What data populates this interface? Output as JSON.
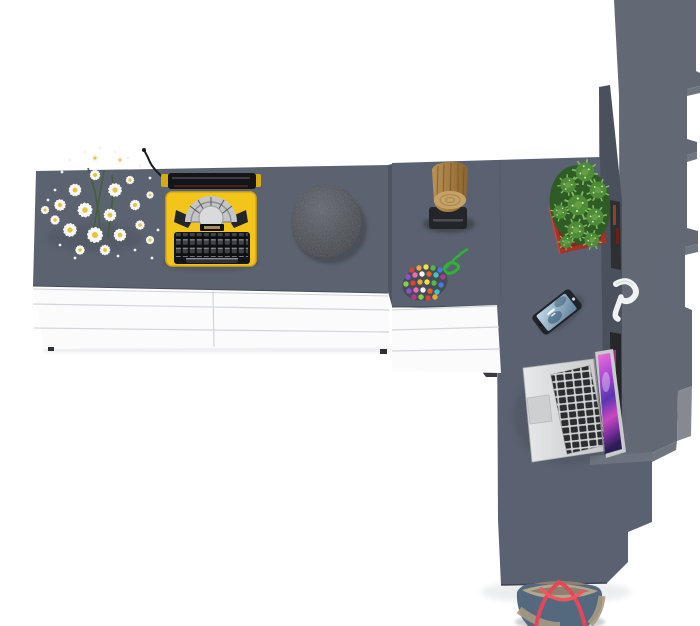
{
  "scene": {
    "title": "Top-down 3D render of an L-shaped desk with sideboard, tall shelf, and desk accessories",
    "background": "#ffffff"
  },
  "items": [
    {
      "name": "daisy-bouquet",
      "label": "white daisy bouquet"
    },
    {
      "name": "typewriter",
      "label": "yellow vintage typewriter with black keyboard"
    },
    {
      "name": "stone-pouf",
      "label": "dark gray textured round object"
    },
    {
      "name": "log-stool",
      "label": "wooden log stool on black base"
    },
    {
      "name": "bead-charm",
      "label": "multicolored bead charm with green cord"
    },
    {
      "name": "cactus",
      "label": "green cactus in red square pot"
    },
    {
      "name": "smartphone",
      "label": "smartphone with blue lock screen"
    },
    {
      "name": "headphones",
      "label": "white headphones on shelf edge"
    },
    {
      "name": "laptop",
      "label": "silver laptop with colorful wallpaper"
    },
    {
      "name": "tote-bag",
      "label": "blue and beige tote bag with red straps"
    }
  ],
  "colors": {
    "bg": "#ffffff",
    "desk_top": "#5c6370",
    "desk_top2": "#5a6170",
    "slab": "#626974",
    "panel": "#4b515c",
    "step_light": "#70767f",
    "seam": "#4e5461",
    "edge_dark": "#474c57",
    "drawer_white": "#fbfbfc",
    "drawer_seam": "#d3d5d8",
    "under_drawer": "#383c43",
    "foot_dark": "#2e3134",
    "typewriter_yellow": "#f3c41a",
    "typewriter_yellow_dark": "#d7a512",
    "machine_black": "#141518",
    "machine_silver": "#c3c5c7",
    "stone_mid": "#46494f",
    "log_mid": "#a37a40",
    "log_face": "#c5a366",
    "stool_base": "#232528",
    "cord_green": "#2db336",
    "pot_red": "#a33328",
    "cactus_green": "#4e8c38",
    "cactus_light": "#7fb85c",
    "phone_body": "#202329",
    "laptop_silver": "#d8dadc",
    "laptop_key": "#2b2d30",
    "screen_pink": "#ef6fd4",
    "screen_purple": "#5a34b0",
    "bag_blue": "#54697e",
    "bag_trim": "#a79a84",
    "bag_strap": "#e4475a",
    "flower_white": "#f7f7f4",
    "flower_center": "#e6c441",
    "stem_green": "#44603a",
    "bead_backing": "#3a3d41",
    "bead_palette": [
      "#d94040",
      "#e8a93c",
      "#f2e14c",
      "#58b847",
      "#3f7de0",
      "#8e4fd8",
      "#e86fb1",
      "#f5f5f5",
      "#e06428",
      "#47c2c9",
      "#b03a8c",
      "#7fd14b"
    ]
  }
}
